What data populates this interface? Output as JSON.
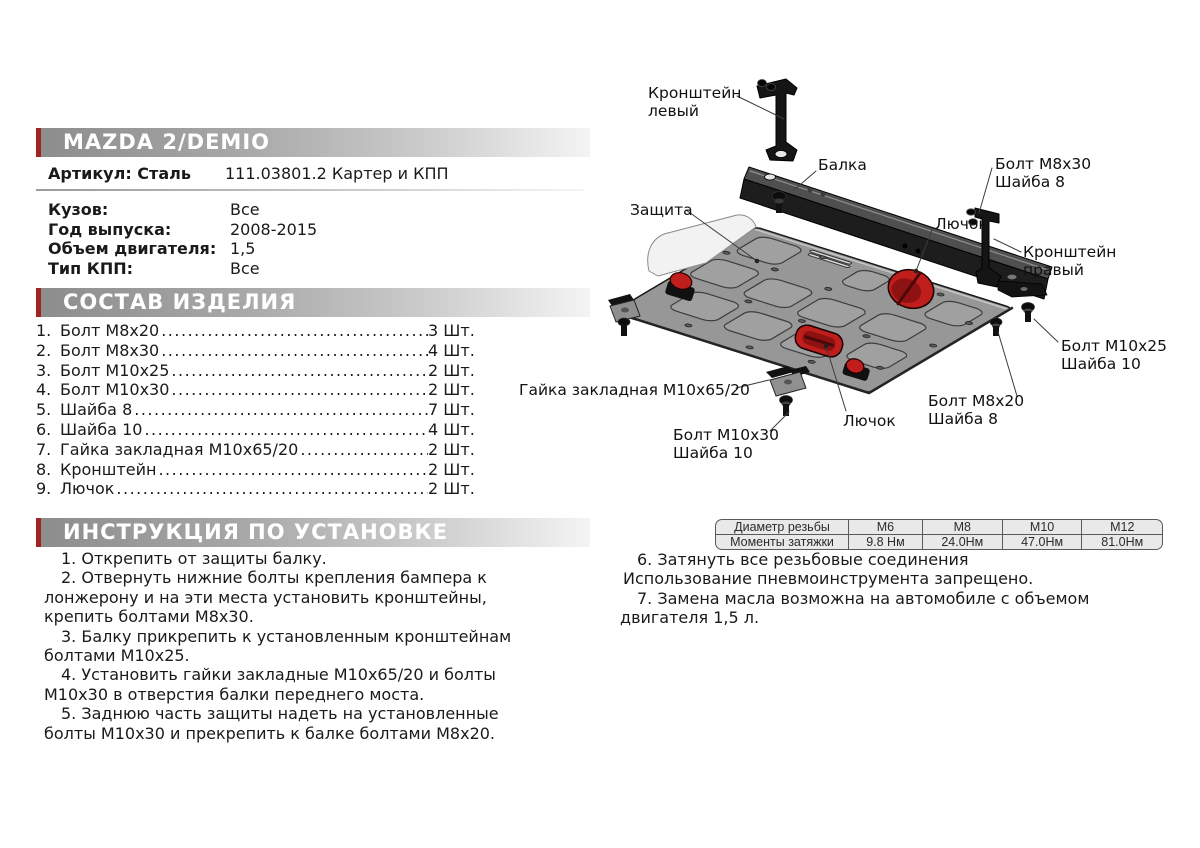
{
  "product": {
    "title": "MAZDA 2/DEMIO",
    "article_label": "Артикул: Сталь",
    "article_value": "111.03801.2 Картер и КПП",
    "specs": [
      {
        "label": "Кузов:",
        "value": "Все"
      },
      {
        "label": "Год выпуска:",
        "value": "2008-2015"
      },
      {
        "label": "Объем двигателя:",
        "value": "1,5"
      },
      {
        "label": "Тип КПП:",
        "value": "Все"
      }
    ]
  },
  "parts": {
    "title": "СОСТАВ ИЗДЕЛИЯ",
    "items": [
      {
        "num": "1.",
        "name": "Болт М8х20",
        "qty": "3 Шт."
      },
      {
        "num": "2.",
        "name": "Болт М8х30",
        "qty": "4 Шт."
      },
      {
        "num": "3.",
        "name": "Болт М10х25",
        "qty": "2 Шт."
      },
      {
        "num": "4.",
        "name": "Болт М10х30",
        "qty": "2 Шт."
      },
      {
        "num": "5.",
        "name": "Шайба 8",
        "qty": "7 Шт."
      },
      {
        "num": "6.",
        "name": "Шайба 10",
        "qty": "4 Шт."
      },
      {
        "num": "7.",
        "name": "Гайка закладная М10х65/20",
        "qty": "2 Шт."
      },
      {
        "num": "8.",
        "name": "Кронштейн",
        "qty": "2 Шт."
      },
      {
        "num": "9.",
        "name": "Лючок",
        "qty": "2 Шт."
      }
    ]
  },
  "instructions": {
    "title": "ИНСТРУКЦИЯ ПО УСТАНОВКЕ",
    "left_steps": [
      {
        "text": "1. Открепить от защиты балку.",
        "indent": true
      },
      {
        "text": "2. Отвернуть нижние болты крепления бампера к лонжерону и на эти места установить кронштейны, крепить болтами М8х30.",
        "indent": true
      },
      {
        "text": "3. Балку прикрепить к установленным кронштейнам болтами М10х25.",
        "indent": true
      },
      {
        "text": "4. Установить гайки закладные М10х65/20 и болты М10х30 в отверстия балки переднего моста.",
        "indent": true
      },
      {
        "text": "5. Заднюю часть защиты надеть на установленные болты М10х30 и прекрепить к балке болтами М8х20.",
        "indent": true
      }
    ],
    "right_steps": [
      {
        "text": "6. Затянуть все резьбовые соединения",
        "indent": true
      },
      {
        "text": "Использование пневмоинструмента запрещено.",
        "indent": false
      },
      {
        "text": "7. Замена масла возможна на автомобиле с объемом двигателя 1,5 л.",
        "indent": true
      }
    ]
  },
  "torque_table": {
    "rows": [
      {
        "label": "Диаметр резьбы",
        "values": [
          "М6",
          "М8",
          "М10",
          "М12"
        ]
      },
      {
        "label": "Моменты затяжки",
        "values": [
          "9.8 Нм",
          "24.0Нм",
          "47.0Нм",
          "81.0Нм"
        ]
      }
    ]
  },
  "diagram": {
    "labels": [
      {
        "id": "label-kronshtein-left",
        "lines": [
          "Кронштейн",
          "левый"
        ],
        "x": 648,
        "y": 84,
        "leader": [
          737,
          96,
          784,
          119
        ]
      },
      {
        "id": "label-balka",
        "lines": [
          "Балка"
        ],
        "x": 818,
        "y": 156,
        "leader": [
          816,
          171,
          794,
          190
        ]
      },
      {
        "id": "label-bolt-m8x30",
        "lines": [
          "Болт М8х30",
          "Шайба 8"
        ],
        "x": 995,
        "y": 155,
        "leader": [
          992,
          168,
          979,
          213
        ]
      },
      {
        "id": "label-kronshtein-right",
        "lines": [
          "Кронштейн",
          "правый"
        ],
        "x": 1023,
        "y": 243,
        "leader": [
          1021,
          252,
          994,
          239
        ]
      },
      {
        "id": "label-zashchita",
        "lines": [
          "Защита"
        ],
        "x": 630,
        "y": 201,
        "leader": [
          686,
          210,
          757,
          261
        ],
        "dot": true
      },
      {
        "id": "label-lyuchok-top",
        "lines": [
          "Лючок"
        ],
        "x": 935,
        "y": 215,
        "leader": [
          932,
          230,
          916,
          271
        ],
        "dot": true
      },
      {
        "id": "label-gaika",
        "lines": [
          "Гайка закладная М10х65/20"
        ],
        "x": 519,
        "y": 381,
        "leader": [
          736,
          388,
          769,
          380
        ]
      },
      {
        "id": "label-bolt-m10x30",
        "lines": [
          "Болт М10х30",
          "Шайба 10"
        ],
        "x": 673,
        "y": 426,
        "leader": [
          770,
          431,
          789,
          412
        ]
      },
      {
        "id": "label-lyuchok-bottom",
        "lines": [
          "Лючок"
        ],
        "x": 843,
        "y": 412,
        "leader": [
          846,
          411,
          826,
          346
        ],
        "dot": true
      },
      {
        "id": "label-bolt-m8x20",
        "lines": [
          "Болт М8х20",
          "Шайба 8"
        ],
        "x": 928,
        "y": 392,
        "leader": [
          1017,
          396,
          998,
          332
        ]
      },
      {
        "id": "label-bolt-m10x25",
        "lines": [
          "Болт М10х25",
          "Шайба 10"
        ],
        "x": 1061,
        "y": 337,
        "leader": [
          1058,
          342,
          1034,
          319
        ]
      }
    ]
  },
  "colors": {
    "accent_red": "#a32222",
    "hatch_red": "#c01d1d",
    "hatch_dark_red": "#8e1212",
    "bar_gray_start": "#8d8d8d",
    "bar_gray_end": "#f4f4f4",
    "plate_gray": "#979797",
    "table_cell_bg": "#e9e9e9"
  }
}
